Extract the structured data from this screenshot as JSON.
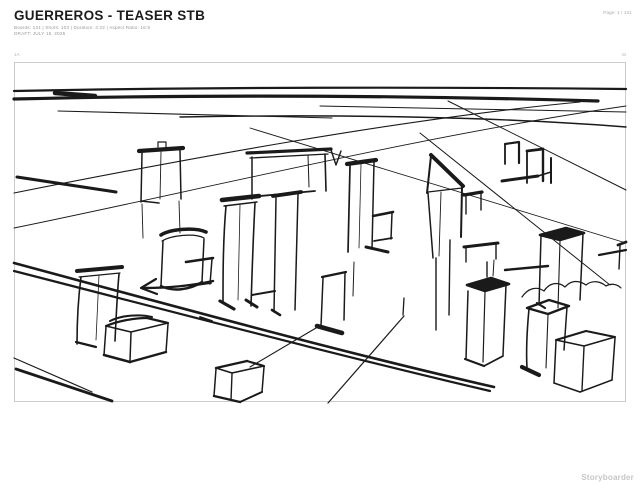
{
  "header": {
    "title": "GUERREROS - TEASER STB",
    "stats": "Boards: 131  |  Shots: 103  |  Duration: 4:22  |  Aspect Ratio: 16:9",
    "draft": "DRAFT: JULY 15, 2025",
    "page": "Page: 1 / 131"
  },
  "board": {
    "number": "1A",
    "duration": "4s"
  },
  "footer": {
    "watermark": "Storyboarder"
  },
  "colors": {
    "ink": "#1a1a1a",
    "frame_border": "#cccccc",
    "meta_text": "#9a9a9a",
    "watermark_text": "#c5c5c5"
  },
  "sketch": {
    "description": "Rough two-point-perspective ink sketch of a city block: horizon band, converging street lines, a wide double-stroked road crossing diagonally, a left-pointing arrow, and about twenty loose box-shaped buildings with dark roof strokes.",
    "strokes": [
      {
        "d": "M14,91 C200,87 440,87 626,89",
        "w": 2.2
      },
      {
        "d": "M14,99 C220,94 430,96 598,101",
        "w": 3.2
      },
      {
        "d": "M55,93 L95,96",
        "w": 4.5
      },
      {
        "d": "M180,117 C340,114 500,117 626,127",
        "w": 1.4
      },
      {
        "d": "M58,111 L332,118",
        "w": 1.1
      },
      {
        "d": "M320,106 L626,112",
        "w": 1.0
      },
      {
        "d": "M14,193 C180,160 400,119 580,102",
        "w": 1.1
      },
      {
        "d": "M14,228 C200,190 420,136 626,106",
        "w": 0.9
      },
      {
        "d": "M17,177 L116,192",
        "w": 3.0
      },
      {
        "d": "M250,128 L626,243",
        "w": 0.9
      },
      {
        "d": "M420,133 L610,285",
        "w": 1.0
      },
      {
        "d": "M448,101 L626,190",
        "w": 1.0
      },
      {
        "d": "M14,263 C170,305 340,352 494,387",
        "w": 2.6
      },
      {
        "d": "M14,271 C170,311 340,356 490,391",
        "w": 2.2
      },
      {
        "d": "M404,316 L328,403",
        "w": 1.2
      },
      {
        "d": "M316,328 L250,367",
        "w": 1.1
      },
      {
        "d": "M14,358 L92,392",
        "w": 1.2
      },
      {
        "d": "M16,369 L112,401",
        "w": 2.8
      },
      {
        "d": "M522,297 c6,-9 15,-11 22,-6 c5,-8 14,-10 21,-4 c6,-7 14,-7 21,-2 c6,-5 14,-4 20,1 c5,-3 11,-2 15,2",
        "w": 1.2
      },
      {
        "d": "M505,270 L548,266",
        "w": 2.4
      },
      {
        "d": "M599,255 L626,250",
        "w": 2.2
      },
      {
        "d": "M252,295 L275,291",
        "w": 2.0
      },
      {
        "d": "M404,298 L403,315",
        "w": 1.3
      },
      {
        "d": "M200,317 L212,321",
        "w": 1.8
      },
      {
        "d": "M213,281 C190,286 165,288 144,288",
        "w": 2.4
      },
      {
        "d": "M156,279 L141,288 L157,294",
        "w": 2.2
      },
      {
        "d": "M139,151 L183,148",
        "w": 4.2
      },
      {
        "d": "M142,153 L141,202",
        "w": 1.5
      },
      {
        "d": "M180,150 L181,199",
        "w": 1.5
      },
      {
        "d": "M161,152 L160,199",
        "w": 0.9
      },
      {
        "d": "M141,201 L159,203",
        "w": 1.6
      },
      {
        "d": "M158,147 L158,142 L166,142 L166,147",
        "w": 1.2
      },
      {
        "d": "M142,204 L143,238",
        "w": 0.9
      },
      {
        "d": "M179,201 L180,233",
        "w": 0.9
      },
      {
        "d": "M247,153 L331,149",
        "w": 3.2
      },
      {
        "d": "M250,158 L328,154",
        "w": 1.3
      },
      {
        "d": "M252,157 L252,199",
        "w": 1.5
      },
      {
        "d": "M325,154 L326,191",
        "w": 1.6
      },
      {
        "d": "M308,155 L309,187",
        "w": 1.0
      },
      {
        "d": "M249,197 L315,191",
        "w": 1.8
      },
      {
        "d": "M331,150 L336,165 L341,151",
        "w": 1.4
      },
      {
        "d": "M161,235 C170,229 195,227 206,232",
        "w": 3.6
      },
      {
        "d": "M162,241 C172,235 195,233 204,238",
        "w": 1.2
      },
      {
        "d": "M163,241 L161,286",
        "w": 1.5
      },
      {
        "d": "M204,239 L202,282",
        "w": 1.5
      },
      {
        "d": "M161,286 C172,292 190,290 202,282",
        "w": 2.4
      },
      {
        "d": "M186,262 L213,258",
        "w": 2.6
      },
      {
        "d": "M212,259 L210,284",
        "w": 1.5
      },
      {
        "d": "M190,286 L211,283",
        "w": 1.8
      },
      {
        "d": "M222,200 L259,196",
        "w": 4.6
      },
      {
        "d": "M224,206 L257,202",
        "w": 1.4
      },
      {
        "d": "M226,206 C223,240 223,275 223,303",
        "w": 1.6
      },
      {
        "d": "M255,203 C253,240 252,275 251,306",
        "w": 1.6
      },
      {
        "d": "M240,205 L238,300",
        "w": 0.8
      },
      {
        "d": "M220,301 L234,309",
        "w": 3.2
      },
      {
        "d": "M246,300 L257,307",
        "w": 3.0
      },
      {
        "d": "M273,196 L301,192",
        "w": 3.8
      },
      {
        "d": "M276,198 L274,312",
        "w": 1.5
      },
      {
        "d": "M298,194 L295,310",
        "w": 1.5
      },
      {
        "d": "M272,310 L280,315",
        "w": 2.6
      },
      {
        "d": "M347,164 L376,160",
        "w": 4.2
      },
      {
        "d": "M350,166 L348,252",
        "w": 1.7
      },
      {
        "d": "M374,162 L372,249",
        "w": 1.5
      },
      {
        "d": "M361,164 L359,248",
        "w": 0.8
      },
      {
        "d": "M373,216 L393,212",
        "w": 2.6
      },
      {
        "d": "M392,213 L391,239",
        "w": 1.5
      },
      {
        "d": "M374,241 L392,238",
        "w": 1.7
      },
      {
        "d": "M366,247 L388,252",
        "w": 3.0
      },
      {
        "d": "M322,277 L346,272",
        "w": 2.2
      },
      {
        "d": "M323,278 L321,326",
        "w": 1.5
      },
      {
        "d": "M345,273 L344,320",
        "w": 1.5
      },
      {
        "d": "M317,326 L342,333",
        "w": 4.6
      },
      {
        "d": "M354,262 L353,296",
        "w": 1.0
      },
      {
        "d": "M431,155 L463,186",
        "w": 4.0
      },
      {
        "d": "M431,156 L427,193",
        "w": 2.0
      },
      {
        "d": "M428,192 L462,188",
        "w": 1.2
      },
      {
        "d": "M428,193 L433,258",
        "w": 1.5
      },
      {
        "d": "M462,187 L461,237",
        "w": 2.0
      },
      {
        "d": "M441,192 L439,256",
        "w": 0.9
      },
      {
        "d": "M436,258 L436,330",
        "w": 1.4
      },
      {
        "d": "M450,240 L449,315",
        "w": 1.4
      },
      {
        "d": "M464,195 L482,192",
        "w": 3.2
      },
      {
        "d": "M466,196 L466,214",
        "w": 1.4
      },
      {
        "d": "M481,193 L481,210",
        "w": 1.4
      },
      {
        "d": "M464,247 L498,243",
        "w": 3.0
      },
      {
        "d": "M466,248 L466,262",
        "w": 1.4
      },
      {
        "d": "M496,244 L496,259",
        "w": 1.4
      },
      {
        "d": "M505,144 L505,164",
        "w": 1.8
      },
      {
        "d": "M505,144 L519,142 L519,163",
        "w": 2.2
      },
      {
        "d": "M527,151 L527,183",
        "w": 1.8
      },
      {
        "d": "M527,151 L543,149",
        "w": 2.8
      },
      {
        "d": "M543,149 L543,181",
        "w": 2.4
      },
      {
        "d": "M502,181 L538,176",
        "w": 3.0
      },
      {
        "d": "M538,176 L551,172",
        "w": 1.6
      },
      {
        "d": "M551,158 L551,183",
        "w": 2.0
      },
      {
        "d": "M540,235 L566,228 L584,233 L560,240 Z",
        "w": 2.6,
        "f": 1
      },
      {
        "d": "M541,236 L539,305",
        "w": 1.5
      },
      {
        "d": "M560,241 L558,308",
        "w": 1.1
      },
      {
        "d": "M583,234 L580,300",
        "w": 1.5
      },
      {
        "d": "M537,303 L545,308",
        "w": 2.2
      },
      {
        "d": "M618,245 L626,242",
        "w": 2.8
      },
      {
        "d": "M620,246 L619,269",
        "w": 1.4
      },
      {
        "d": "M77,271 L122,267",
        "w": 4.0
      },
      {
        "d": "M79,277 L120,273",
        "w": 1.2
      },
      {
        "d": "M81,277 C78,300 77,325 77,344",
        "w": 1.6
      },
      {
        "d": "M119,274 C117,296 116,320 115,341",
        "w": 1.6
      },
      {
        "d": "M99,275 L96,340",
        "w": 0.8
      },
      {
        "d": "M76,342 L96,347",
        "w": 2.2
      },
      {
        "d": "M106,326 C118,321 134,318 147,318",
        "w": 2.2
      },
      {
        "d": "M147,318 L168,323",
        "w": 2.2
      },
      {
        "d": "M168,323 L131,332",
        "w": 1.6
      },
      {
        "d": "M131,332 L106,326",
        "w": 1.6
      },
      {
        "d": "M110,321 C122,315 140,314 152,317",
        "w": 2.0
      },
      {
        "d": "M106,327 L104,355",
        "w": 1.5
      },
      {
        "d": "M104,355 L130,362",
        "w": 2.6
      },
      {
        "d": "M131,333 L130,361",
        "w": 1.5
      },
      {
        "d": "M168,324 L166,352",
        "w": 1.5
      },
      {
        "d": "M130,362 L166,352",
        "w": 2.4
      },
      {
        "d": "M216,368 L247,361",
        "w": 2.4
      },
      {
        "d": "M247,361 L264,366",
        "w": 2.2
      },
      {
        "d": "M264,366 L232,373",
        "w": 1.6
      },
      {
        "d": "M232,373 L216,368",
        "w": 1.6
      },
      {
        "d": "M216,369 L214,396",
        "w": 1.5
      },
      {
        "d": "M214,396 L240,402",
        "w": 2.4
      },
      {
        "d": "M232,374 L231,400",
        "w": 1.4
      },
      {
        "d": "M264,367 L262,392",
        "w": 1.5
      },
      {
        "d": "M240,402 L262,392",
        "w": 2.0
      },
      {
        "d": "M467,285 L491,278 L509,284 L485,291 Z",
        "w": 2.6,
        "f": 1
      },
      {
        "d": "M468,291 L466,359",
        "w": 1.5
      },
      {
        "d": "M485,292 L483,362",
        "w": 1.2
      },
      {
        "d": "M506,285 L503,355",
        "w": 1.5
      },
      {
        "d": "M465,359 L484,366",
        "w": 2.2
      },
      {
        "d": "M484,366 L503,356",
        "w": 1.8
      },
      {
        "d": "M487,262 L487,277",
        "w": 1.4
      },
      {
        "d": "M494,260 L493,276",
        "w": 1.0
      },
      {
        "d": "M527,308 L549,300 L569,306 L548,314 Z",
        "w": 2.4
      },
      {
        "d": "M529,309 C527,330 526,350 527,368",
        "w": 1.6
      },
      {
        "d": "M548,315 L546,368",
        "w": 1.1
      },
      {
        "d": "M567,307 L564,350",
        "w": 1.5
      },
      {
        "d": "M522,367 L539,375",
        "w": 4.2
      },
      {
        "d": "M556,340 L586,331",
        "w": 2.2
      },
      {
        "d": "M586,331 L615,337",
        "w": 2.0
      },
      {
        "d": "M615,337 L584,346",
        "w": 1.6
      },
      {
        "d": "M584,346 L556,340",
        "w": 1.6
      },
      {
        "d": "M556,341 L554,383",
        "w": 1.5
      },
      {
        "d": "M554,383 L580,392",
        "w": 1.6
      },
      {
        "d": "M584,347 L582,390",
        "w": 1.4
      },
      {
        "d": "M615,338 L612,380",
        "w": 1.5
      },
      {
        "d": "M580,392 L612,380",
        "w": 1.5
      }
    ]
  }
}
